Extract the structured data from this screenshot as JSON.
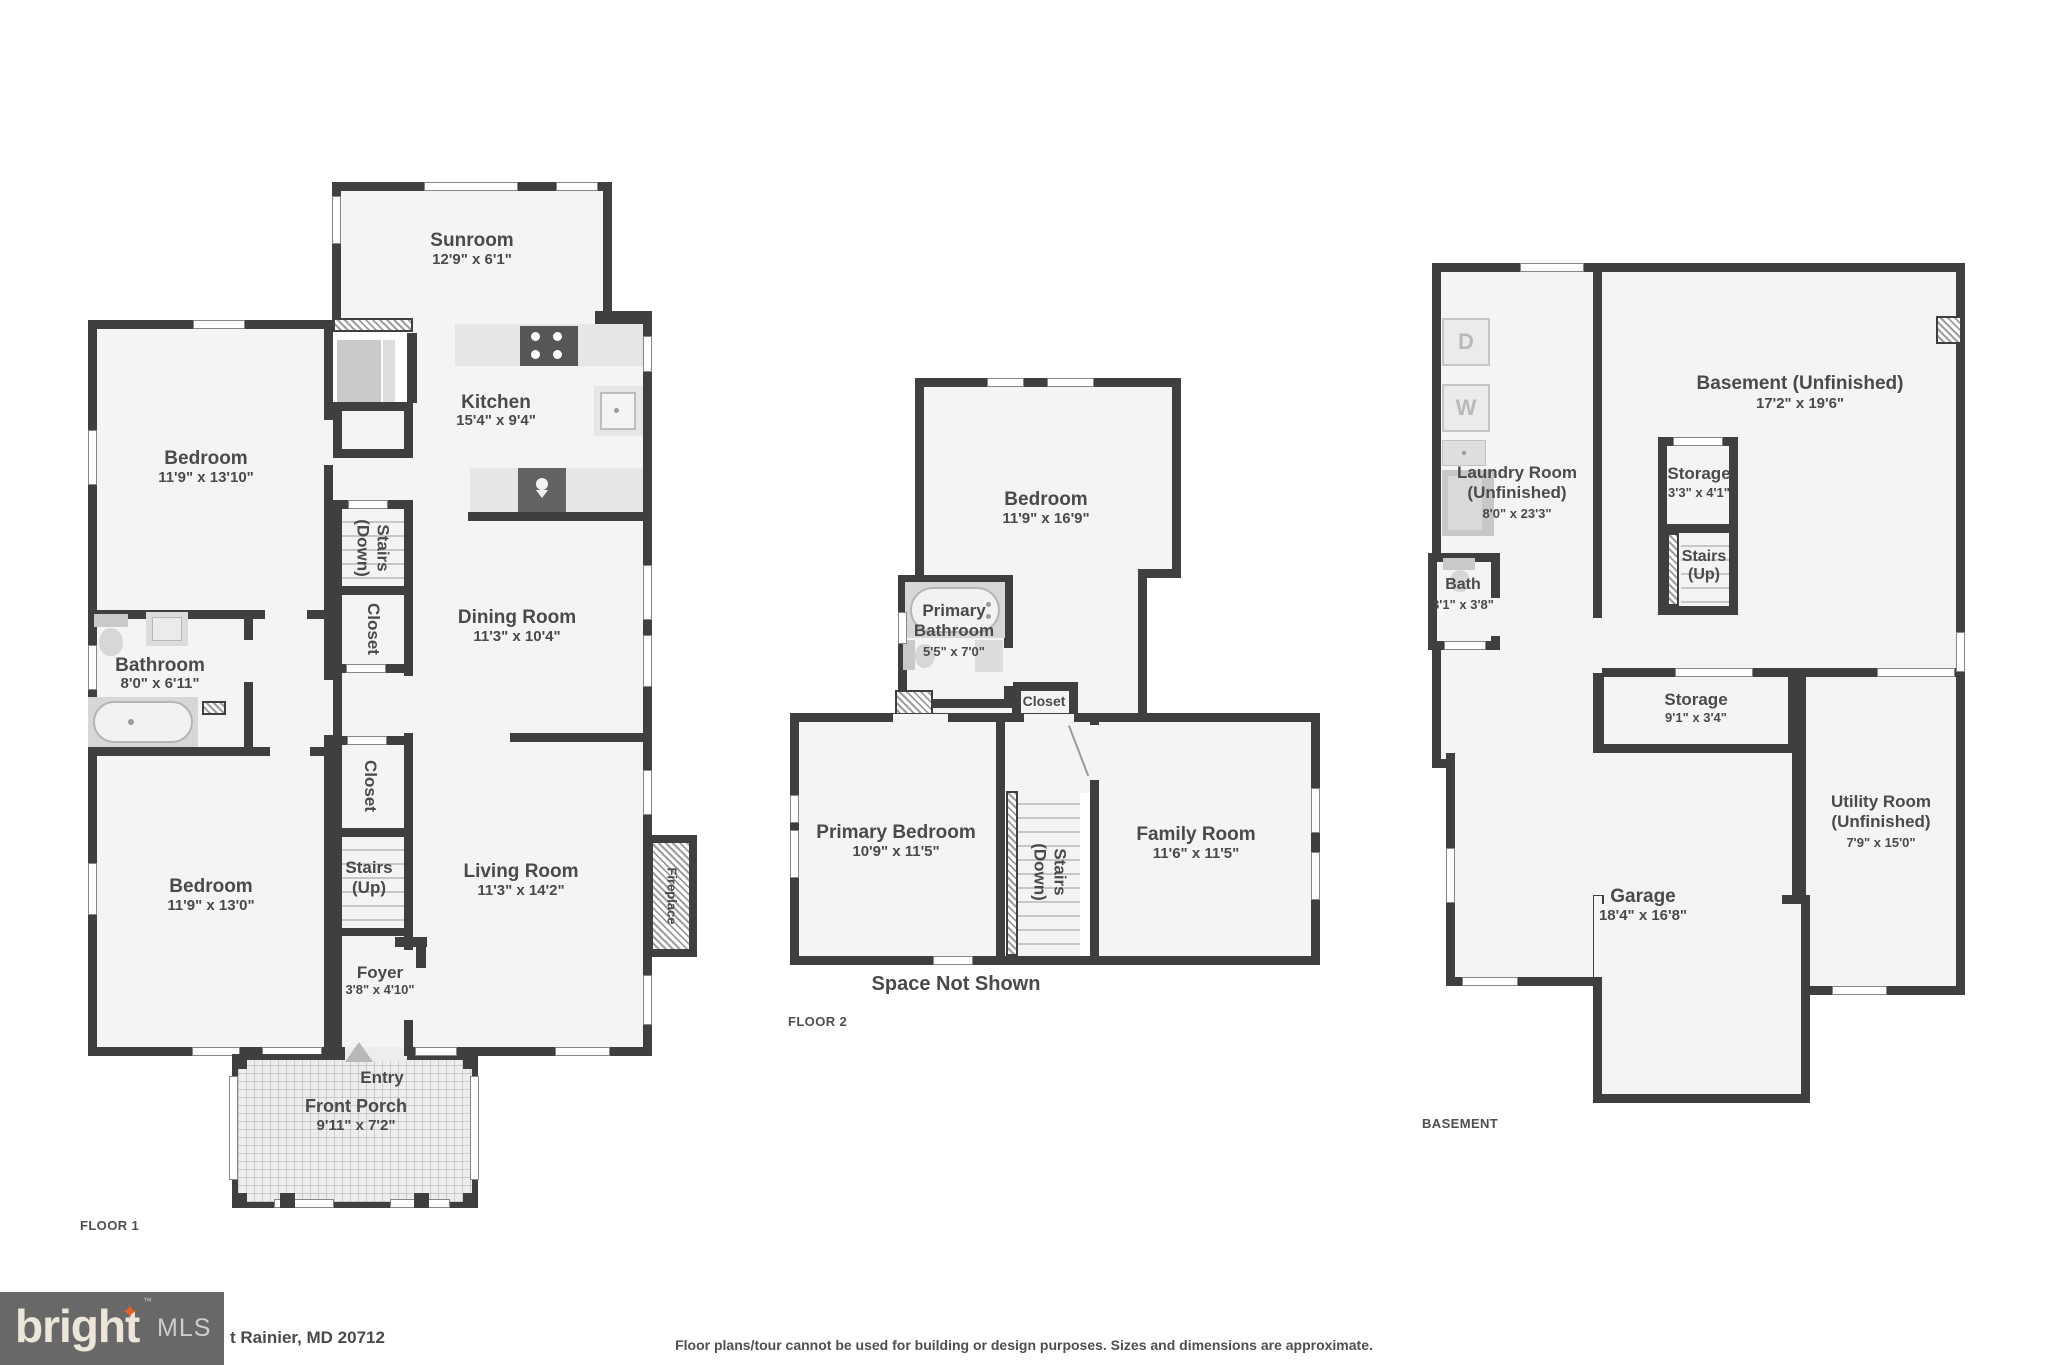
{
  "floor1": {
    "label": "FLOOR 1",
    "rooms": {
      "sunroom": {
        "name": "Sunroom",
        "dim": "12'9\" x 6'1\""
      },
      "kitchen": {
        "name": "Kitchen",
        "dim": "15'4\" x 9'4\""
      },
      "bedroom_top": {
        "name": "Bedroom",
        "dim": "11'9\" x 13'10\""
      },
      "stairs_down": {
        "name": "Stairs (Down)"
      },
      "closet_a": {
        "name": "Closet"
      },
      "dining": {
        "name": "Dining Room",
        "dim": "11'3\" x 10'4\""
      },
      "bathroom": {
        "name": "Bathroom",
        "dim": "8'0\" x 6'11\""
      },
      "bedroom_bottom": {
        "name": "Bedroom",
        "dim": "11'9\" x 13'0\""
      },
      "closet_b": {
        "name": "Closet"
      },
      "stairs_up": {
        "name": "Stairs (Up)"
      },
      "living": {
        "name": "Living Room",
        "dim": "11'3\" x 14'2\""
      },
      "fireplace": {
        "name": "Fireplace"
      },
      "foyer": {
        "name": "Foyer",
        "dim": "3'8\" x 4'10\""
      },
      "entry": {
        "name": "Entry"
      },
      "porch": {
        "name": "Front Porch",
        "dim": "9'11\" x 7'2\""
      }
    }
  },
  "floor2": {
    "label": "FLOOR 2",
    "note": "Space Not Shown",
    "rooms": {
      "bedroom": {
        "name": "Bedroom",
        "dim": "11'9\" x 16'9\""
      },
      "primary_bath": {
        "name": "Primary Bathroom",
        "dim": "5'5\" x 7'0\""
      },
      "closet": {
        "name": "Closet"
      },
      "primary_bedroom": {
        "name": "Primary Bedroom",
        "dim": "10'9\" x 11'5\""
      },
      "stairs_down": {
        "name": "Stairs (Down)"
      },
      "family": {
        "name": "Family Room",
        "dim": "11'6\" x 11'5\""
      }
    }
  },
  "basement": {
    "label": "BASEMENT",
    "rooms": {
      "laundry": {
        "name": "Laundry Room (Unfinished)",
        "dim": "8'0\" x 23'3\""
      },
      "bath": {
        "name": "Bath",
        "dim": "3'1\" x 3'8\""
      },
      "main": {
        "name": "Basement (Unfinished)",
        "dim": "17'2\" x 19'6\""
      },
      "storage_small": {
        "name": "Storage",
        "dim": "3'3\" x 4'1\""
      },
      "stairs_up": {
        "name": "Stairs (Up)"
      },
      "storage_wide": {
        "name": "Storage",
        "dim": "9'1\" x 3'4\""
      },
      "utility": {
        "name": "Utility Room (Unfinished)",
        "dim": "7'9\" x 15'0\""
      },
      "garage": {
        "name": "Garage",
        "dim": "18'4\" x 16'8\""
      }
    },
    "appliances": {
      "dryer": "D",
      "washer": "W"
    }
  },
  "footer": {
    "brand": "bright",
    "tm": "™",
    "mls": "MLS",
    "star": "✦",
    "address": "t Rainier, MD 20712",
    "disclaimer": "Floor plans/tour cannot be used for building or design purposes. Sizes and dimensions are approximate."
  },
  "colors": {
    "wall": "#3f3f3f",
    "room_fill": "#f4f4f4",
    "accent_star": "#e2622b"
  }
}
